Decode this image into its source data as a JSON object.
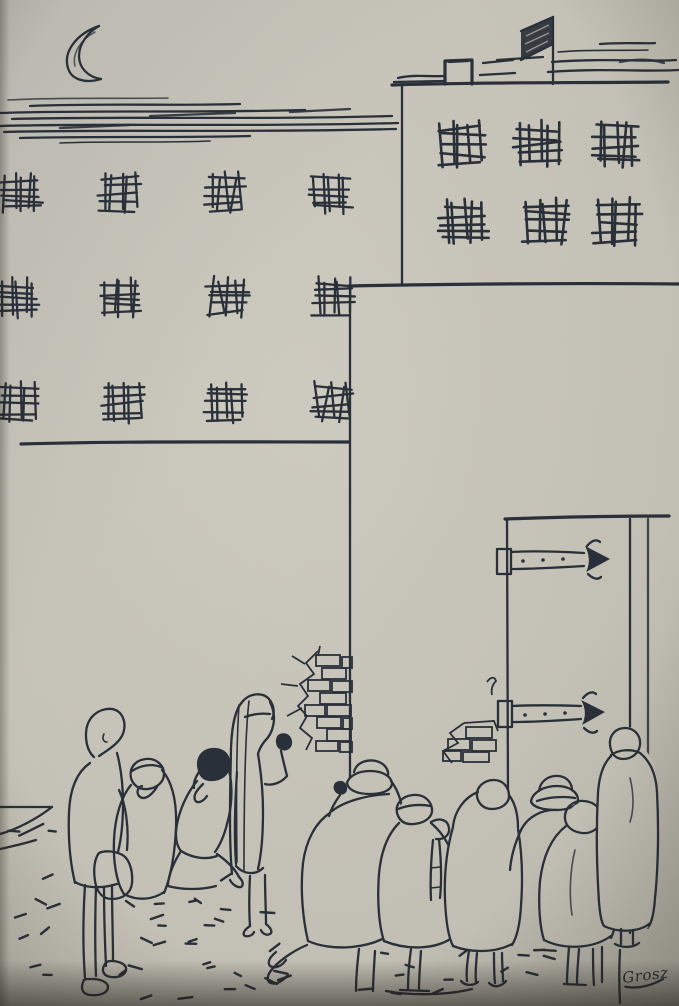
{
  "artwork": {
    "signature": "Grosz"
  },
  "colors": {
    "paper": "#cac7bc",
    "paper_light": "#d3d0c5",
    "paper_shadow": "#a8a69d",
    "ink": "#2a303a",
    "flag_fill": "#2e343d",
    "vignette": "#26231c"
  },
  "scene": {
    "moon": {
      "present": true,
      "orientation": "crescent-open-right"
    },
    "flag": {
      "present": true,
      "on": "right-building-roof"
    },
    "left_building": {
      "window_size": 30,
      "rows": [
        {
          "y": 180,
          "cols": [
            8,
            107,
            212,
            318
          ]
        },
        {
          "y": 285,
          "cols": [
            5,
            108,
            215,
            320
          ]
        },
        {
          "y": 390,
          "cols": [
            5,
            110,
            213,
            320
          ]
        }
      ]
    },
    "right_building": {
      "window_size": 36,
      "rows": [
        {
          "y": 128,
          "cols": [
            445,
            523,
            601
          ]
        },
        {
          "y": 206,
          "cols": [
            448,
            530,
            602
          ]
        }
      ]
    },
    "door": {
      "hinge_count": 2,
      "hinge_style": "arrow"
    },
    "figure_count": 10,
    "ground": {
      "dash_bands": [
        [
          12,
          822,
          48,
          178,
          12
        ],
        [
          120,
          898,
          42,
          100,
          8
        ],
        [
          156,
          854,
          84,
          144,
          14
        ],
        [
          248,
          903,
          58,
          92,
          6
        ],
        [
          358,
          938,
          118,
          56,
          8
        ],
        [
          503,
          946,
          58,
          42,
          6
        ]
      ]
    }
  }
}
